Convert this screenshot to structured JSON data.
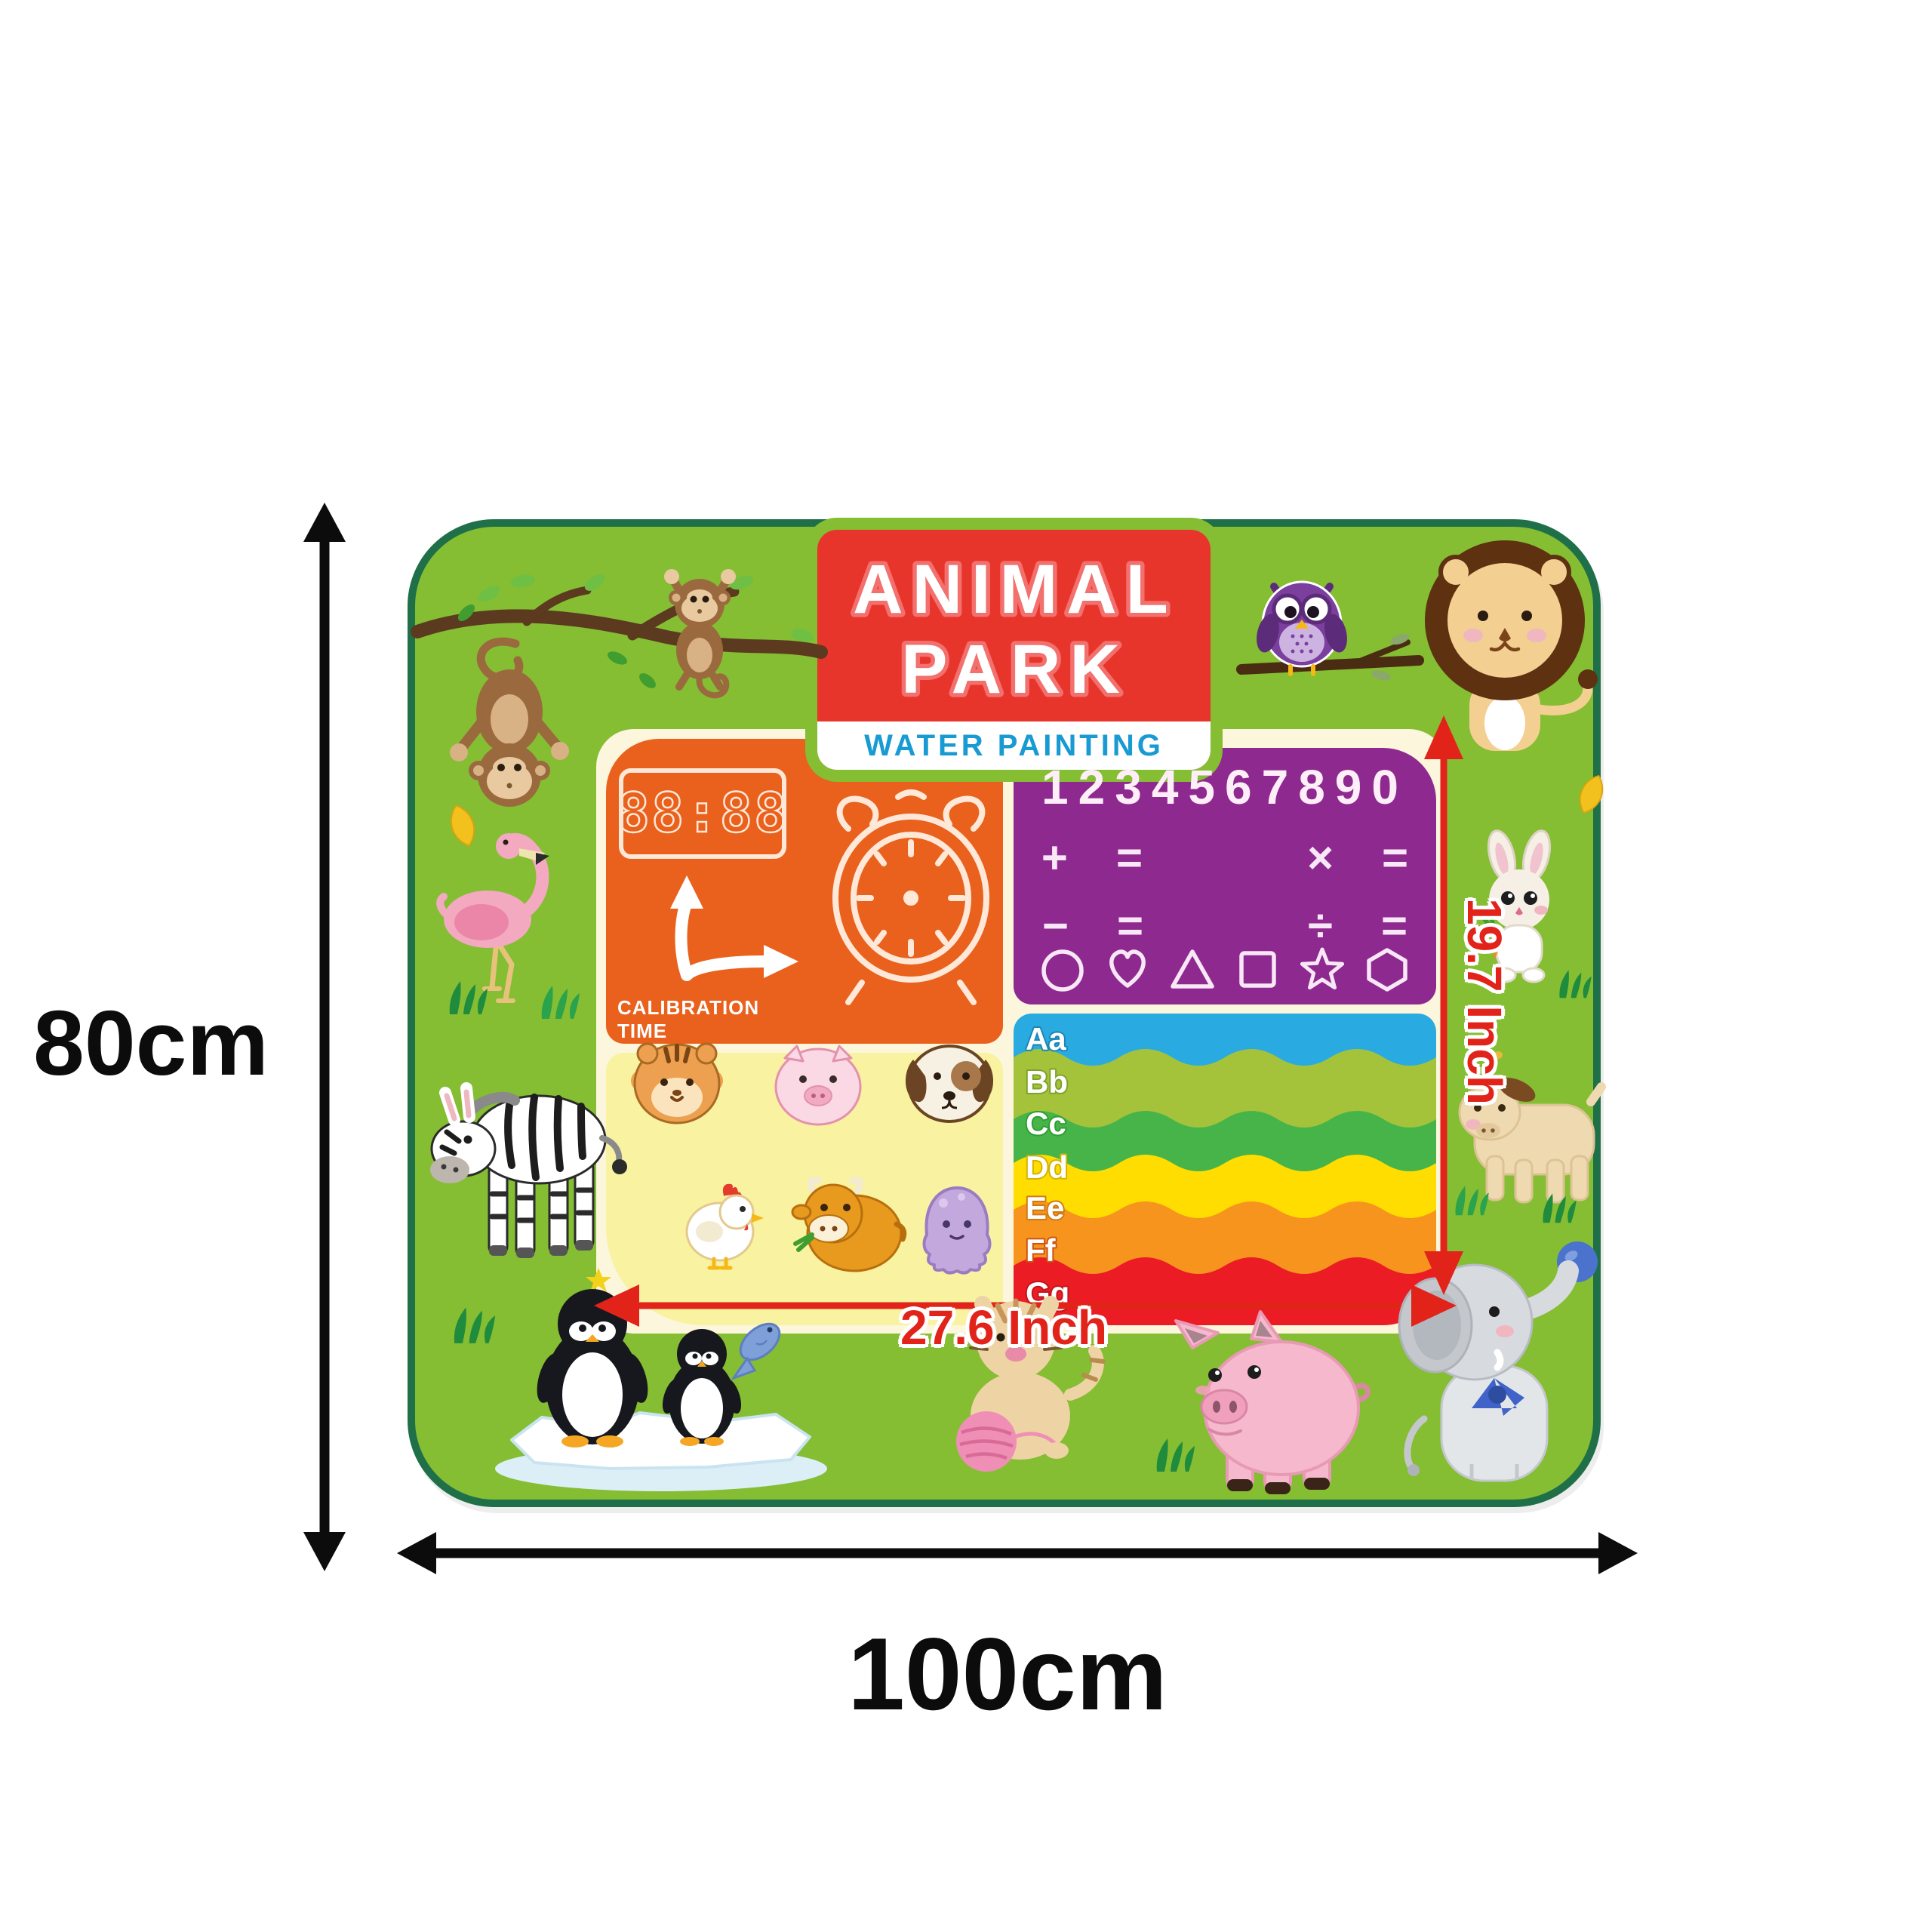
{
  "image_type": "product dimension illustration of a kids water painting mat",
  "dimensions": {
    "height_label": "80cm",
    "width_label": "100cm",
    "inner_width_label": "27.6 Inch",
    "inner_height_label": "19.7 Inch"
  },
  "mat": {
    "title_line1": "ANIMAL",
    "title_line2": "PARK",
    "subtitle": "WATER PAINTING",
    "panels": {
      "calibration": {
        "display": "88:88",
        "label": "CALIBRATION TIME",
        "icons": [
          "digital-clock-display",
          "bent-arrow",
          "alarm-clock"
        ]
      },
      "math": {
        "numbers": "1234567890",
        "operator_rows": [
          [
            "+",
            "=",
            "×",
            "="
          ],
          [
            "−",
            "=",
            "÷",
            "="
          ]
        ],
        "shapes": [
          "circle",
          "heart",
          "triangle",
          "square",
          "star",
          "hexagon"
        ]
      },
      "animals_panel": {
        "items": [
          "tiger",
          "piglet",
          "dog",
          "hen",
          "ox",
          "octopus"
        ]
      },
      "alphabet": {
        "letters": [
          "Aa",
          "Bb",
          "Cc",
          "Dd",
          "Ee",
          "Ff",
          "Gg"
        ],
        "band_colors": [
          "#29abe2",
          "#a4c33b",
          "#47b44a",
          "#ffdd00",
          "#f7941e",
          "#ec1c24"
        ]
      }
    },
    "decor_animals": [
      "monkey-hanging",
      "monkey-on-branch",
      "owl",
      "lion",
      "flamingo",
      "zebra",
      "rabbit",
      "goat",
      "penguin-big",
      "penguin-small",
      "fish",
      "cat-with-yarn",
      "pig",
      "elephant-with-ball"
    ]
  },
  "colors": {
    "mat_green": "#85bd33",
    "mat_border": "#1f7048",
    "banner_red": "#e8352b",
    "subtitle_blue": "#189ad2",
    "panel_orange": "#e9611c",
    "panel_purple": "#8e2a8f",
    "panel_yellow": "#f9f2a0",
    "panel_cream": "#fcf6dd",
    "dimension_red": "#e2231a",
    "dimension_black": "#0c0c0c"
  }
}
